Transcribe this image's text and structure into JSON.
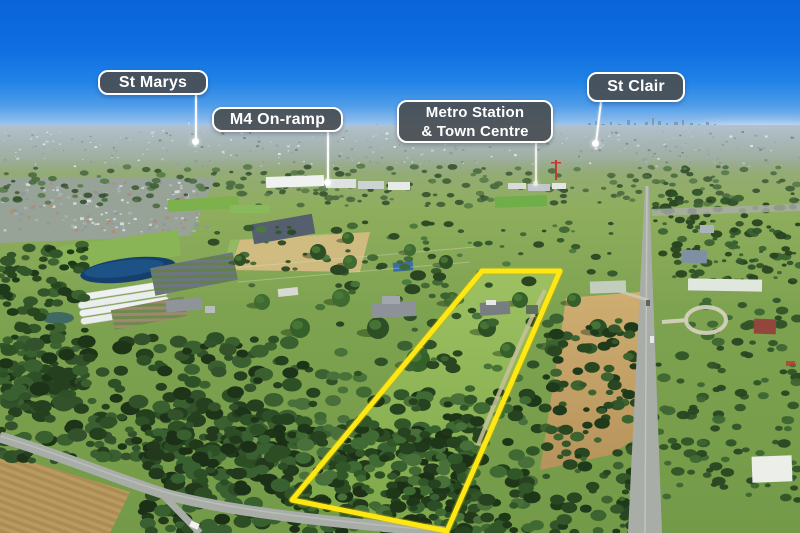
{
  "scene": {
    "type": "aerial drone photograph with location callouts and lot boundary",
    "boundary_color": "#ffe714",
    "callout_bg_color": "#494f53",
    "callout_border_color": "#ffffff",
    "callout_text_color": "#ffffff"
  },
  "callouts": {
    "st_marys": {
      "label": "St Marys"
    },
    "m4_on_ramp": {
      "label": "M4 On-ramp"
    },
    "metro": {
      "line1": "Metro Station",
      "line2": "& Town Centre"
    },
    "st_clair": {
      "label": "St Clair"
    }
  }
}
